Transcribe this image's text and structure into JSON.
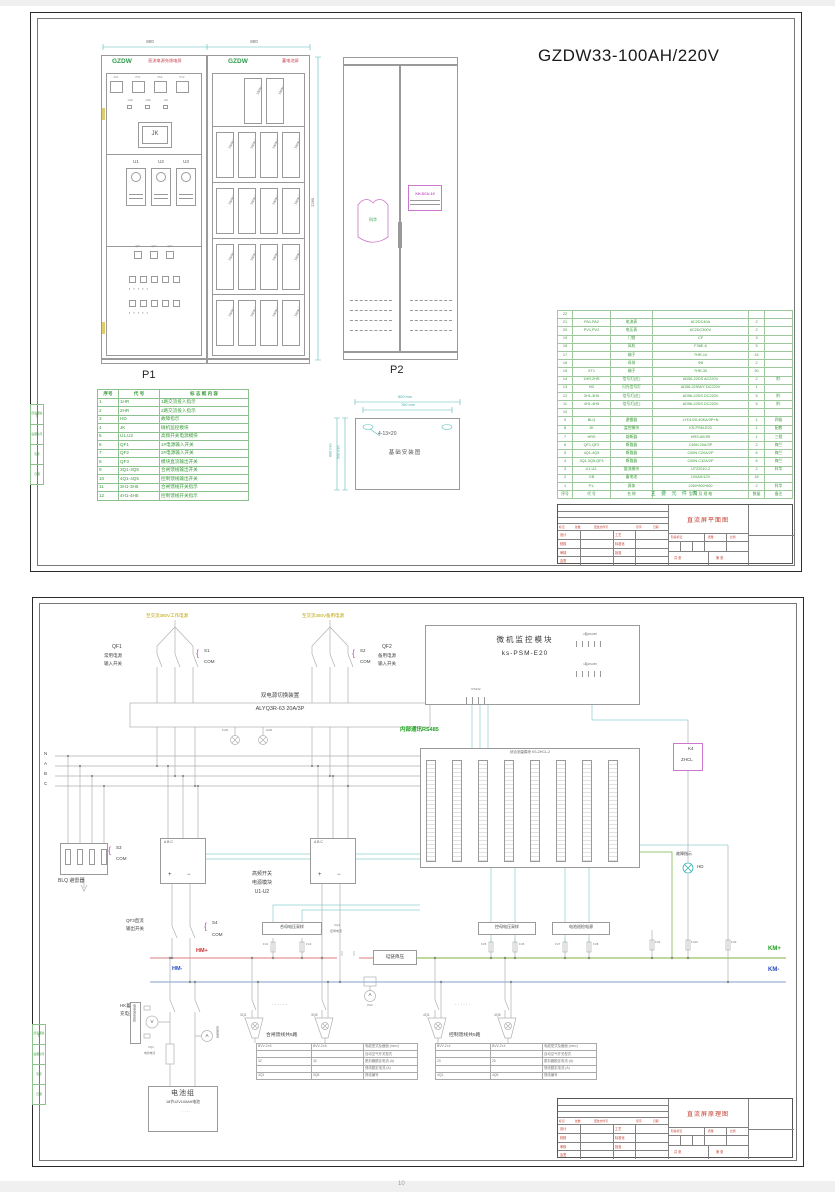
{
  "s1": {
    "title": "GZDW33-100AH/220V",
    "dims": {
      "p1": "800",
      "p2": "800",
      "bat_side": "2260",
      "f_top_outer": "800 mm",
      "f_top_inner": "760 mm",
      "f_left_outer": "800 mm",
      "f_left_inner": "500 mm"
    },
    "dc": {
      "brand": "GZDW",
      "name": "直流电源充馈电屏",
      "meters": [
        "PA1",
        "PV1",
        "PA2",
        "PV2"
      ],
      "lamps": [
        "1HR",
        "2HR",
        "HD"
      ],
      "jk": "JK",
      "modules": [
        "U1",
        "U2",
        "U3"
      ],
      "switches": [
        "QF1",
        "QF2",
        "QF3"
      ],
      "label": "P1"
    },
    "bat": {
      "brand": "GZDW",
      "name": "蓄电池屏",
      "block": "100AH/12V"
    },
    "p2": {
      "logo": "科华",
      "device": "KH-DCU-19",
      "label": "P2"
    },
    "legend": {
      "headers": [
        "序号",
        "代  号",
        "标 志 框 内 容"
      ],
      "rows": [
        [
          "1",
          "1HR",
          "1路交流投入指示"
        ],
        [
          "2",
          "2HR",
          "2路交流投入指示"
        ],
        [
          "3",
          "HD",
          "故障指示"
        ],
        [
          "4",
          "JK",
          "微机监控模块"
        ],
        [
          "5",
          "U1,U2",
          "高频开关电源模块"
        ],
        [
          "6",
          "QF1",
          "1#电源输入开关"
        ],
        [
          "7",
          "QF2",
          "2#电源输入开关"
        ],
        [
          "8",
          "QF3",
          "模块直流输出开关"
        ],
        [
          "9",
          "3Q1-3Q5",
          "合闸馈线输出开关"
        ],
        [
          "10",
          "4Q1-4Q5",
          "控制馈线输出开关"
        ],
        [
          "11",
          "3H1-3H5",
          "合闸馈线开关指示"
        ],
        [
          "12",
          "4H1-4H5",
          "控制馈线开关指示"
        ]
      ]
    },
    "found": {
      "caption": "基础安装图",
      "slot": "4-13×20"
    },
    "bom": {
      "caption": "主 要 元 件 表",
      "rows": [
        [
          "22",
          "",
          "",
          "",
          "",
          ""
        ],
        [
          "21",
          "PA1,PA2",
          "电流表",
          "6C2DC40A",
          "2",
          ""
        ],
        [
          "20",
          "PV1,PV2",
          "电压表",
          "6C2DC300V",
          "2",
          ""
        ],
        [
          "19",
          "",
          "门锁",
          "CF",
          "3",
          ""
        ],
        [
          "18",
          "",
          "风机",
          "F36E-6",
          "5",
          ""
        ],
        [
          "17",
          "",
          "端子",
          "THR-10",
          "24",
          ""
        ],
        [
          "16",
          "",
          "母排",
          "Φ8",
          "2",
          ""
        ],
        [
          "15",
          "XT1",
          "端子",
          "THR-30",
          "30",
          ""
        ],
        [
          "14",
          "1HR,2HR",
          "信号灯(红)",
          "AD56-22DS AC220V",
          "2",
          "附:"
        ],
        [
          "13",
          "HD",
          "闪光信号灯",
          "AD56-22SM/Y DC220V",
          "1",
          ""
        ],
        [
          "12",
          "3H1-3H5",
          "信号灯(红)",
          "AD56-22DS DC220V",
          "5",
          "附:"
        ],
        [
          "11",
          "4H1-4H5",
          "信号灯(红)",
          "AD56-22DS DC220V",
          "5",
          "附:"
        ],
        [
          "10",
          "",
          "",
          "",
          "",
          ""
        ],
        [
          "9",
          "BLQ",
          "避雷器",
          "LYD1/20-40KA/3P+N",
          "1",
          "四极"
        ],
        [
          "8",
          "JK",
          "监控模块",
          "KS-PSM-E20",
          "1",
          "配套"
        ],
        [
          "7",
          "HRS",
          "熔断器",
          "HRS-60/3R",
          "1",
          "三相"
        ],
        [
          "6",
          "QF1,QF2",
          "断路器",
          "C65N 20A/3P",
          "2",
          "梅兰"
        ],
        [
          "5",
          "4Q1-4Q5",
          "断路器",
          "C65N C20A/2P",
          "6",
          "梅兰"
        ],
        [
          "4",
          "3Q1-3Q5,QF3",
          "断路器",
          "C65N C32A/2P",
          "6",
          "梅兰"
        ],
        [
          "3",
          "U1,U2,",
          "整流模块",
          "UT22010-2",
          "2",
          "科华"
        ],
        [
          "2",
          "GB",
          "蓄电池",
          "100AH/12V",
          "18",
          ""
        ],
        [
          "1",
          "P1,",
          "屏体",
          "2260*800*600",
          "2",
          "科华"
        ],
        [
          "序号",
          "代 号",
          "名 称",
          "型 号 及 规 格",
          "数量",
          "备注"
        ]
      ]
    },
    "tb_title": "直流屏平面图"
  },
  "tb": {
    "cols": [
      "标记",
      "处数",
      "更改文件号",
      "签字",
      "日期"
    ],
    "left": [
      "设计",
      "校核",
      "审核",
      "会签"
    ],
    "mid": [
      "工艺",
      "标准化",
      "批准"
    ],
    "stage": "阶段标记",
    "mass": "质量",
    "scale": "比例",
    "total": "共  张",
    "no": "第  张"
  },
  "edge": {
    "rows": [
      "旧底图总号",
      "底图总号",
      "签字",
      "日期"
    ]
  },
  "s2": {
    "src_left": "至交流380V工作电源",
    "src_right": "至交流380V备用电源",
    "qf1": {
      "name": "QF1",
      "d1": "常用电源",
      "d2": "输入开关",
      "s": "S1",
      "com": "COM"
    },
    "qf2": {
      "name": "QF2",
      "d1": "备用电源",
      "d2": "输入开关",
      "s": "S2",
      "com": "COM"
    },
    "ats": {
      "name": "双电源切换装置",
      "model": "ALYQ3R-63 20A/3P"
    },
    "lamps": [
      "1HR",
      "2HR"
    ],
    "mon": {
      "t": "微机监控模块",
      "m": "ks-PSM-E20",
      "p1": "2路RS485",
      "p2": "1路RS485",
      "p3": "RS232"
    },
    "rs485": "内部通讯RS485",
    "meas": {
      "t": "综合测量模块 KS-ZHCL-2"
    },
    "k4": {
      "a": "K4",
      "b": "ZHCL"
    },
    "fault": {
      "t": "故障指示",
      "lamp": "HD"
    },
    "phases": [
      "N",
      "A",
      "B",
      "C"
    ],
    "blq": {
      "s": "S3",
      "com": "COM",
      "label": "BLQ 避雷器"
    },
    "rect": {
      "abc": "A    B    C",
      "plus": "+",
      "minus": "−",
      "l1": "高频开关",
      "l2": "电源模块",
      "l3": "U1-U2"
    },
    "qf3": {
      "l1": "QF3直流",
      "l2": "输出开关",
      "s": "S4",
      "com": "COM"
    },
    "hmp": "HM+",
    "hmm": "HM-",
    "kmp": "KM+",
    "kmm": "KM-",
    "sh": {
      "t": "合母电压采样",
      "f1": "FU1",
      "f2": "FU2"
    },
    "cq1": {
      "a": "CQ1",
      "b": "控母电流"
    },
    "drop": "硅链降压",
    "sk": {
      "t": "控母电压采样",
      "f1": "FU5",
      "f2": "FU6"
    },
    "bc": {
      "t": "电池巡检电源",
      "f1": "FU7",
      "f2": "FU8"
    },
    "fr": [
      "FU4",
      "FU10",
      "FU9"
    ],
    "pa2": "PA2",
    "amp": "A",
    "volt": "V",
    "hk": {
      "l1": "HK蓄电池",
      "l2": "充电开关"
    },
    "bs": {
      "t": "电池电压采样"
    },
    "cq2": {
      "a": "CQ2",
      "b": "电池电流"
    },
    "chg": "充电电流",
    "batt": {
      "t": "电池组",
      "sub": "18节12V100AH电池"
    },
    "g1": {
      "t": "合闸馈线共5路",
      "qa": "3Q1",
      "qb": "3Q5",
      "dots": "· · · · · ·"
    },
    "g2": {
      "t": "控制馈线共5路",
      "qa": "4Q1",
      "qb": "4Q5",
      "dots": "· · · · · ·"
    },
    "t1rows": [
      [
        "BVV-2×6",
        "BVV-2×6",
        "电缆型式及截面 (mm²)"
      ],
      [
        "",
        "",
        "自动空气开关型式"
      ],
      [
        "32",
        "32",
        "脱扣器额定电流 (A)"
      ],
      [
        "",
        "",
        "馈线额定电流 (A)"
      ],
      [
        "3Q1",
        "3Q5",
        "馈线编号"
      ]
    ],
    "t2rows": [
      [
        "BVV-2×4",
        "BVV-2×4",
        "电缆型式及截面 (mm²)"
      ],
      [
        "",
        "",
        "自动空气开关型式"
      ],
      [
        "20",
        "20",
        "脱扣器额定电流 (A)"
      ],
      [
        "",
        "",
        "馈线额定电流 (A)"
      ],
      [
        "4Q1",
        "4Q5",
        "馈线编号"
      ]
    ],
    "tb_title": "直流屏原理图"
  },
  "page_number": "10"
}
